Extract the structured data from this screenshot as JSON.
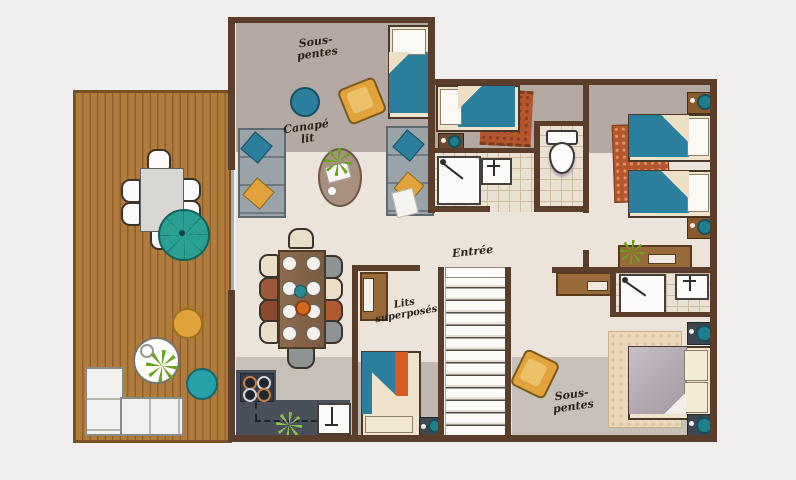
{
  "type": "apartment-floor-plan",
  "labels": {
    "loft_top": {
      "line1": "Sous-",
      "line2": "pentes"
    },
    "sofa_bed": {
      "line1": "Canapé",
      "line2": "lit"
    },
    "entrance": {
      "text": "Entrée"
    },
    "bunk_beds": {
      "line1": "Lits",
      "line2": "superposés"
    },
    "loft_bottom": {
      "line1": "Sous-",
      "line2": "pentes"
    }
  },
  "palette": {
    "background": "#f0efee",
    "wall": "#5a3d2b",
    "deck_wood": "#b07c3e",
    "floor_beige": "#ece4da",
    "floor_taupe": "#b3a9a2",
    "floor_gray": "#c6c0b9",
    "tile": "#ebe1d3",
    "teal": "#2b7e9c",
    "teal_bright": "#2aa093",
    "yellow": "#e2a33c",
    "rust": "#b4562e",
    "slate_counter": "#49505a",
    "sofa_gray": "#99a3a9",
    "duvet_lavender": "#b2a8b0",
    "plant_green": "#69a31f"
  },
  "areas": [
    {
      "name": "deck",
      "furniture": [
        "outdoor-dining-table",
        "outdoor-chair x6",
        "parasol",
        "lounge-corner-sofa",
        "round-coffee-table",
        "plant",
        "yellow-pouf",
        "teal-pouf"
      ]
    },
    {
      "name": "living-room",
      "label_keys": [
        "loft_top",
        "sofa_bed"
      ],
      "furniture": [
        "single-bed",
        "sofa x2",
        "oval-coffee-table",
        "plant",
        "armchair-yellow",
        "teal-pouf"
      ]
    },
    {
      "name": "dining-kitchen",
      "furniture": [
        "dining-table",
        "dining-chair x10",
        "plate x8",
        "bowl-teal",
        "bowl-orange",
        "hob-4-burners",
        "kitchen-sink",
        "plant",
        "counter"
      ]
    },
    {
      "name": "bedroom-single",
      "furniture": [
        "single-bed",
        "rug-rust",
        "nightstand"
      ]
    },
    {
      "name": "shower-room",
      "furniture": [
        "shower-tray",
        "washbasin"
      ]
    },
    {
      "name": "wc",
      "furniture": [
        "toilet"
      ]
    },
    {
      "name": "twin-bedroom",
      "furniture": [
        "single-bed x2",
        "rug-rust",
        "nightstand x2",
        "desk",
        "plant"
      ]
    },
    {
      "name": "bunk-room",
      "label_keys": [
        "bunk_beds"
      ],
      "furniture": [
        "bunk-bed",
        "wardrobe",
        "nightstand"
      ]
    },
    {
      "name": "entrance-hall",
      "label_keys": [
        "entrance"
      ],
      "furniture": [
        "staircase",
        "armchair-yellow"
      ]
    },
    {
      "name": "master-bedroom",
      "label_keys": [
        "loft_bottom"
      ],
      "furniture": [
        "double-bed",
        "rug-beige",
        "nightstand x2",
        "console",
        "shower-tray",
        "washbasin"
      ]
    }
  ]
}
